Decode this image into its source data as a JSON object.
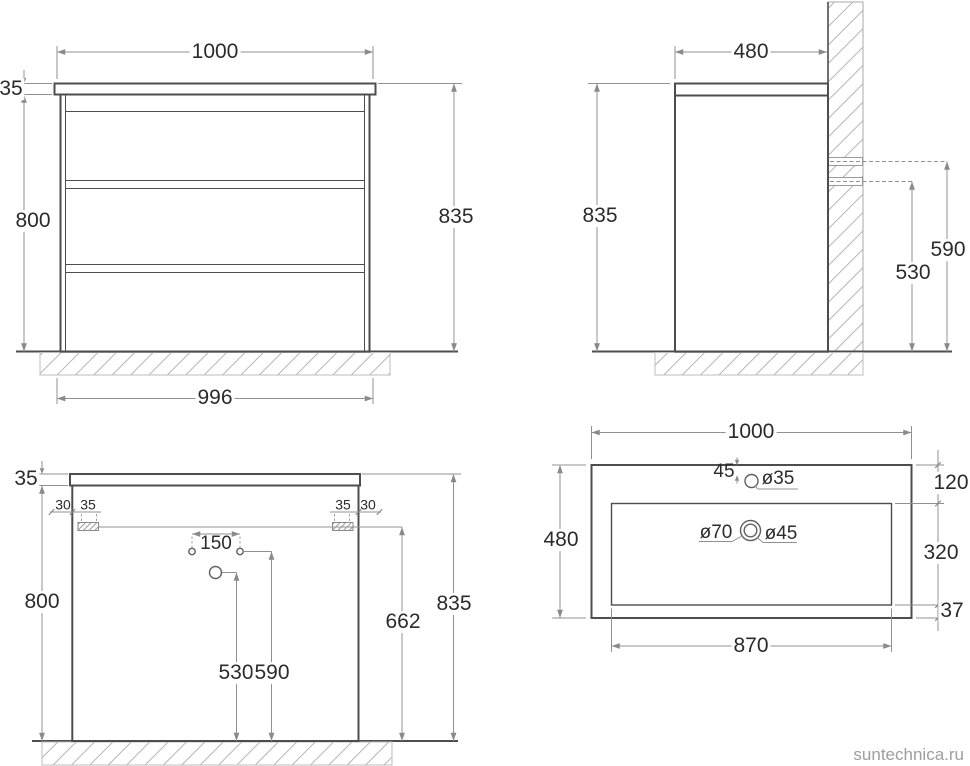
{
  "watermark": "suntechnica.ru",
  "colors": {
    "outline": "#4d4d4d",
    "dimension_lines": "#909090",
    "text": "#2b2b2b",
    "watermark": "#9e9e9e"
  },
  "views": {
    "front": {
      "dims": {
        "top_width": "1000",
        "countertop_thickness": "35",
        "body_height": "800",
        "overall_height": "835",
        "base_width": "996"
      }
    },
    "side": {
      "dims": {
        "depth": "480",
        "overall_height": "835",
        "upper_rail_height": "590",
        "lower_rail_height": "530"
      }
    },
    "rear": {
      "dims": {
        "countertop_thickness": "35",
        "offset_left": "30",
        "bracket_left": "35",
        "bracket_right": "35",
        "offset_right": "30",
        "hole_spacing": "150",
        "body_height": "800",
        "bracket_height": "662",
        "drain_hole_height": "530",
        "supply_holes_height": "590",
        "overall_height": "835"
      }
    },
    "sink": {
      "dims": {
        "width": "1000",
        "faucet_offset": "45",
        "faucet_hole_dia": "ø35",
        "depth": "480",
        "back_margin": "120",
        "drain_outer_dia": "ø70",
        "drain_inner_dia": "ø45",
        "basin_depth": "320",
        "front_margin": "37",
        "basin_width": "870"
      }
    }
  }
}
